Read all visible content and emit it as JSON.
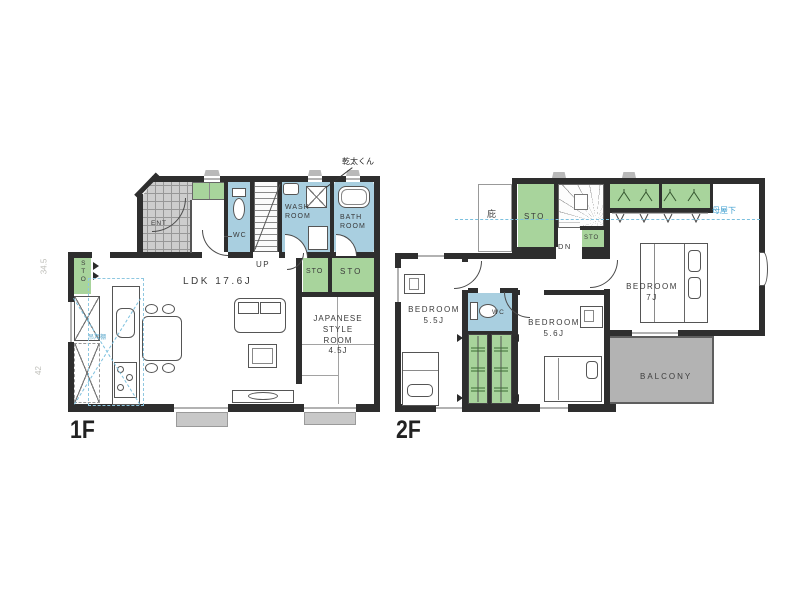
{
  "colors": {
    "wall": "#2e2e2e",
    "wet_area_blue": "#a9cfe0",
    "storage_green": "#a8d49c",
    "balcony_gray": "#b3b3b3",
    "entrance_hatch_gray": "#cdcdcd",
    "annotation_blue": "#4aa6d2"
  },
  "floor1": {
    "floor_label": "1F",
    "ldk_label": "LDK 17.6J",
    "up_label": "UP",
    "ent_label": "ENT",
    "wc_label": "WC",
    "wash_room": [
      "WASH",
      "ROOM"
    ],
    "bath_room": [
      "BATH",
      "ROOM"
    ],
    "japanese_room": [
      "JAPANESE",
      "STYLE",
      "ROOM",
      "4.5J"
    ],
    "sto_label": "STO",
    "dryer_note": "乾太くん",
    "kitchen_note": "吊戸棚",
    "margin_note_top": "34.5",
    "margin_note_bottom": "42"
  },
  "floor2": {
    "floor_label": "2F",
    "dn_label": "DN",
    "sto_label": "STO",
    "eaves_label": "庇",
    "wc_label": "WC",
    "bedroom_55": [
      "BEDROOM",
      "5.5J"
    ],
    "bedroom_56": [
      "BEDROOM",
      "5.6J"
    ],
    "bedroom_7": [
      "BEDROOM",
      "7J"
    ],
    "balcony_label": "BALCONY",
    "ridge_note": "母屋下"
  }
}
